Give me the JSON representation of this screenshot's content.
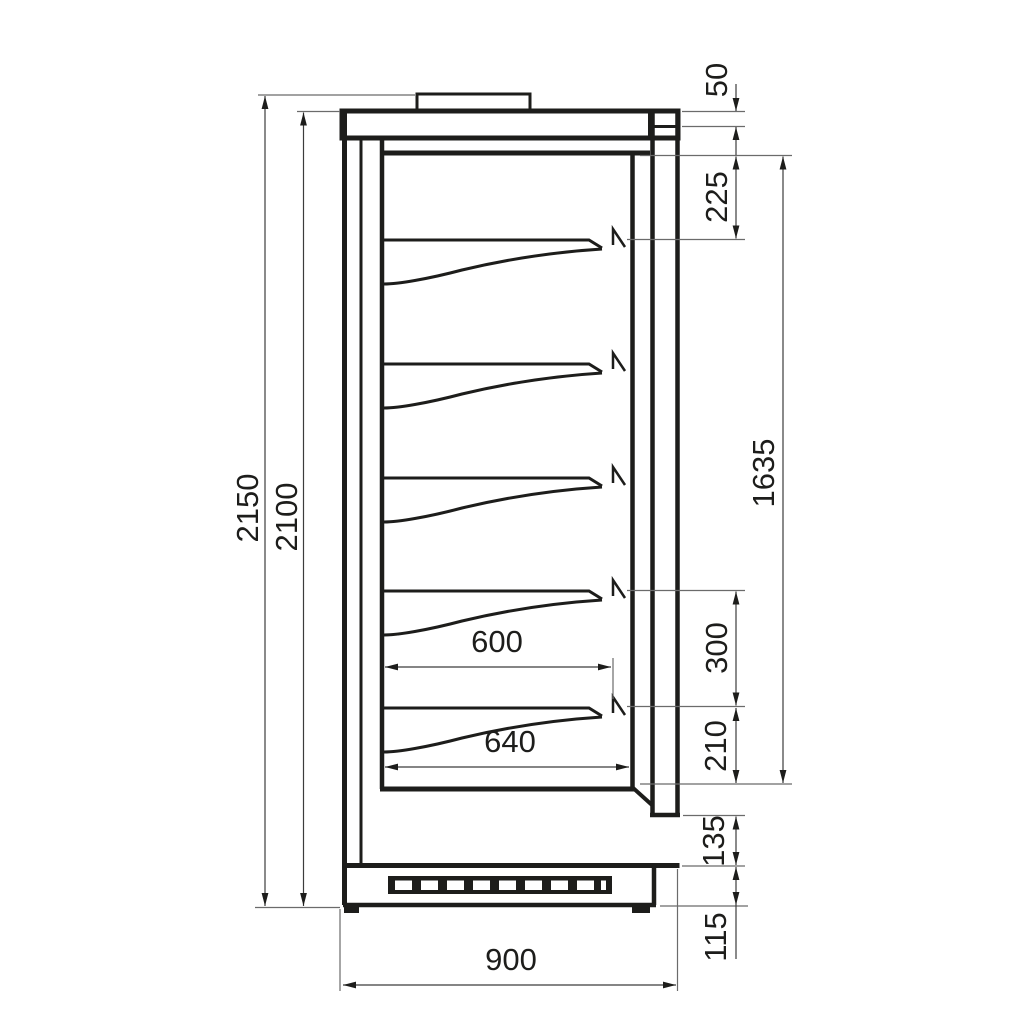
{
  "drawing": {
    "title": "display-cabinet-side-view-technical-drawing",
    "dims": {
      "overall_height": "2150",
      "body_height": "2100",
      "canopy_top": "50",
      "top_to_first_shelf": "225",
      "interior_height": "1635",
      "shelf_spacing": "300",
      "bottom_shelf_to_deck": "210",
      "lower_front_panel": "135",
      "plinth_height": "115",
      "shelf_depth": "600",
      "bottom_shelf_depth": "640",
      "overall_depth": "900"
    }
  }
}
